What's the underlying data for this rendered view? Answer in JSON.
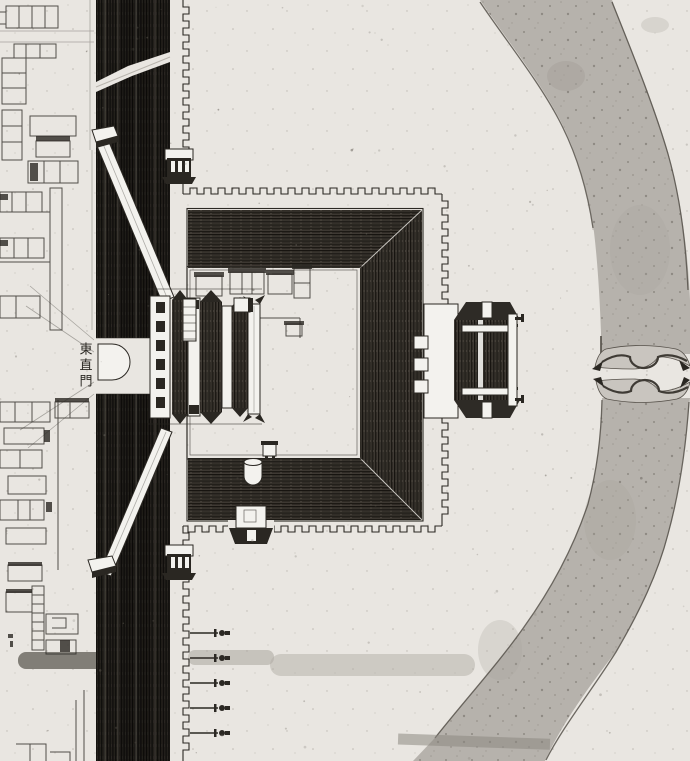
{
  "labels": {
    "gate_name": "東直門"
  },
  "colors": {
    "paper": "#e9e6e1",
    "ink": "#2b2823",
    "wall-dark": "#2a2722",
    "hatch-base": "#433e37",
    "river": "#b6b2ac",
    "river-edge": "#56514a",
    "abutment": "#c9c5bf",
    "road-smear": "#8b8780",
    "paper-white": "#f3f2ee"
  }
}
